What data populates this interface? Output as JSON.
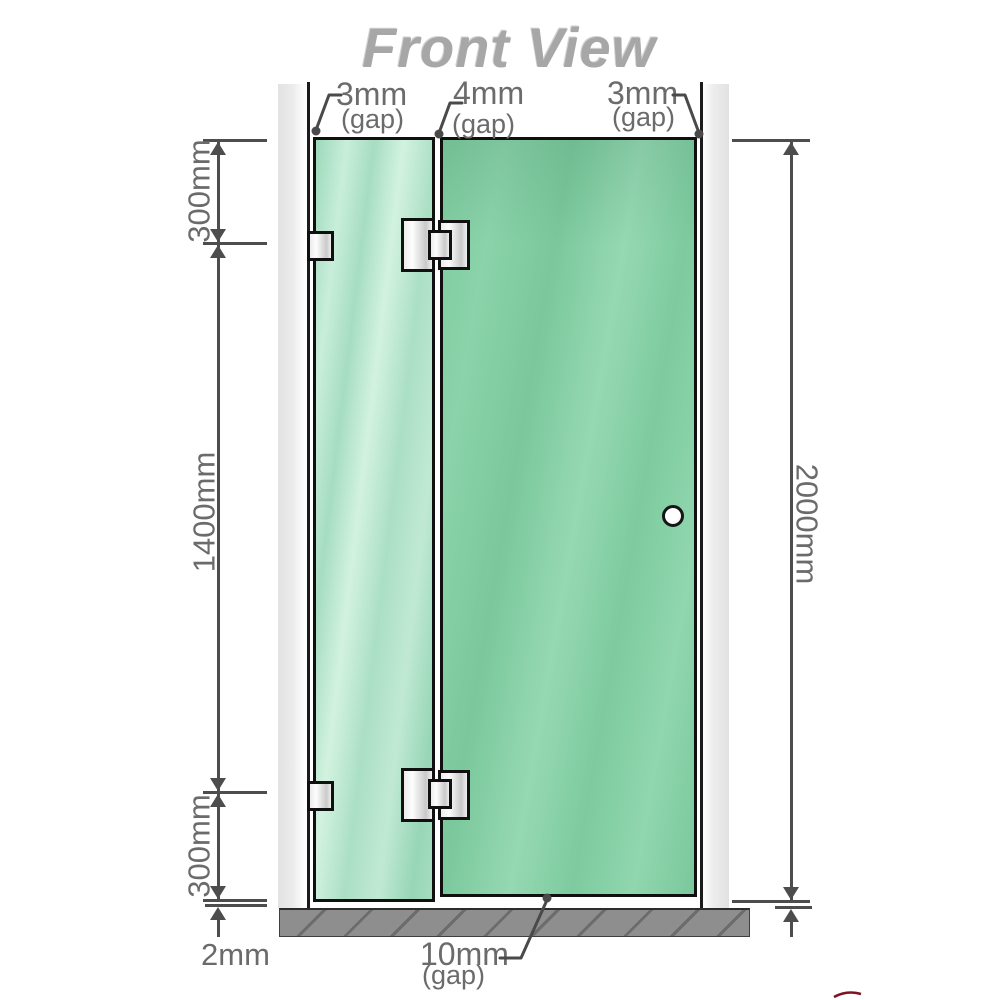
{
  "title": "Front View",
  "top_gap_labels": {
    "left": {
      "value": "3mm",
      "note": "(gap)"
    },
    "middle": {
      "value": "4mm",
      "note": "(gap)"
    },
    "right": {
      "value": "3mm",
      "note": "(gap)"
    }
  },
  "dimension_labels": {
    "left_top": "300mm",
    "left_middle": "1400mm",
    "left_bottom": "300mm",
    "right_total": "2000mm"
  },
  "bottom_labels": {
    "floor_gap": {
      "value": "2mm"
    },
    "door_gap": {
      "value": "10mm",
      "note": "(gap)"
    }
  },
  "colors": {
    "glass_door_green": "#85cfa4",
    "glass_fixed_green": "#b2e2c9",
    "wall_gray": "#e7e7e7",
    "base_gray": "#8e8e8e",
    "dimension_line_gray": "#4d4d4d",
    "label_text_gray": "#6b6b6b",
    "title_gray": "#a7a7a7",
    "logo_mark_red": "#7c1423"
  }
}
